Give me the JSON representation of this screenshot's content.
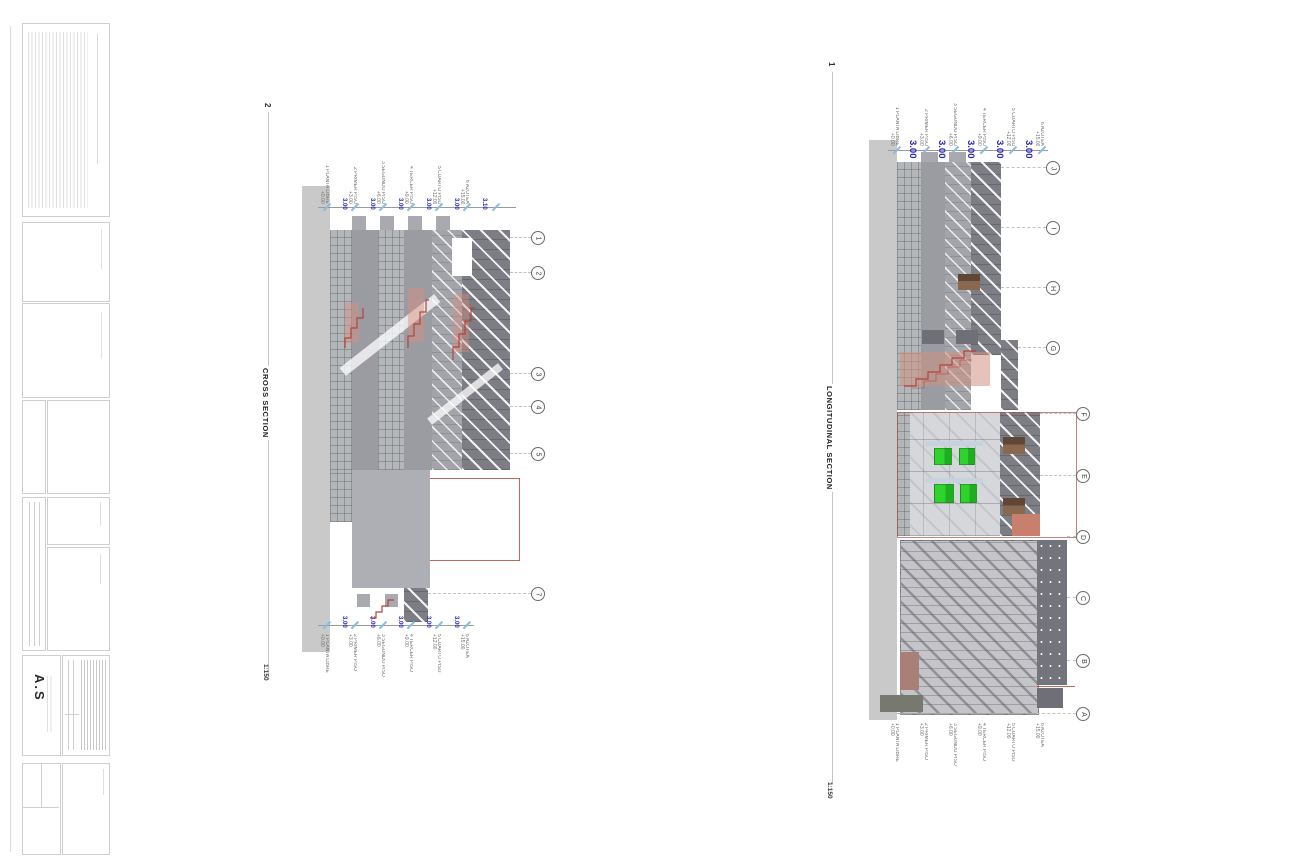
{
  "palette": {
    "dimension_blue": "#2626b8",
    "tick_cyan": "#85bedd",
    "stair_red": "#b2433a",
    "accent_green": "#2ed32e",
    "ground_grey": "#c9c9c9"
  },
  "title_block": {
    "logo_text": "A.S"
  },
  "cross_section": {
    "drawing_number": "2",
    "title": "CROSS SECTION",
    "scale": "1:150",
    "grid_bubbles": [
      "1",
      "2",
      "3",
      "4",
      "5",
      "7"
    ],
    "levels": [
      {
        "name": "1 PLANTA LIBRE",
        "elevation": "+0.00"
      },
      {
        "name": "2 PRIMER PISO",
        "elevation": "+3.00"
      },
      {
        "name": "3 SEGUNDO PISO",
        "elevation": "+6.00"
      },
      {
        "name": "4 TERCER PISO",
        "elevation": "+9.00"
      },
      {
        "name": "5 CUARTO PISO",
        "elevation": "+12.00"
      },
      {
        "name": "6 AZOTEA",
        "elevation": "+15.00"
      }
    ],
    "dims_top": [
      "3.00",
      "3.00",
      "3.00",
      "3.00",
      "3.00",
      "3.10"
    ],
    "dims_bottom": [
      "3.00",
      "3.00",
      "3.00",
      "3.00",
      "3.00"
    ]
  },
  "longitudinal_section": {
    "drawing_number": "1",
    "title": "LONGITUDINAL SECTION",
    "scale": "1:150",
    "grid_bubbles": [
      "J",
      "I",
      "H",
      "G",
      "F",
      "E",
      "D",
      "C",
      "B",
      "A"
    ],
    "levels": [
      {
        "name": "1 PLANTA LIBRE",
        "elevation": "+0.00"
      },
      {
        "name": "2 PRIMER PISO",
        "elevation": "+3.00"
      },
      {
        "name": "3 SEGUNDO PISO",
        "elevation": "+6.00"
      },
      {
        "name": "4 TERCER PISO",
        "elevation": "+9.00"
      },
      {
        "name": "5 CUARTO PISO",
        "elevation": "+12.00"
      },
      {
        "name": "6 AZOTEA",
        "elevation": "+15.00"
      }
    ],
    "dims_top": [
      "3.00",
      "3.00",
      "3.00",
      "3.00",
      "3.00"
    ]
  }
}
